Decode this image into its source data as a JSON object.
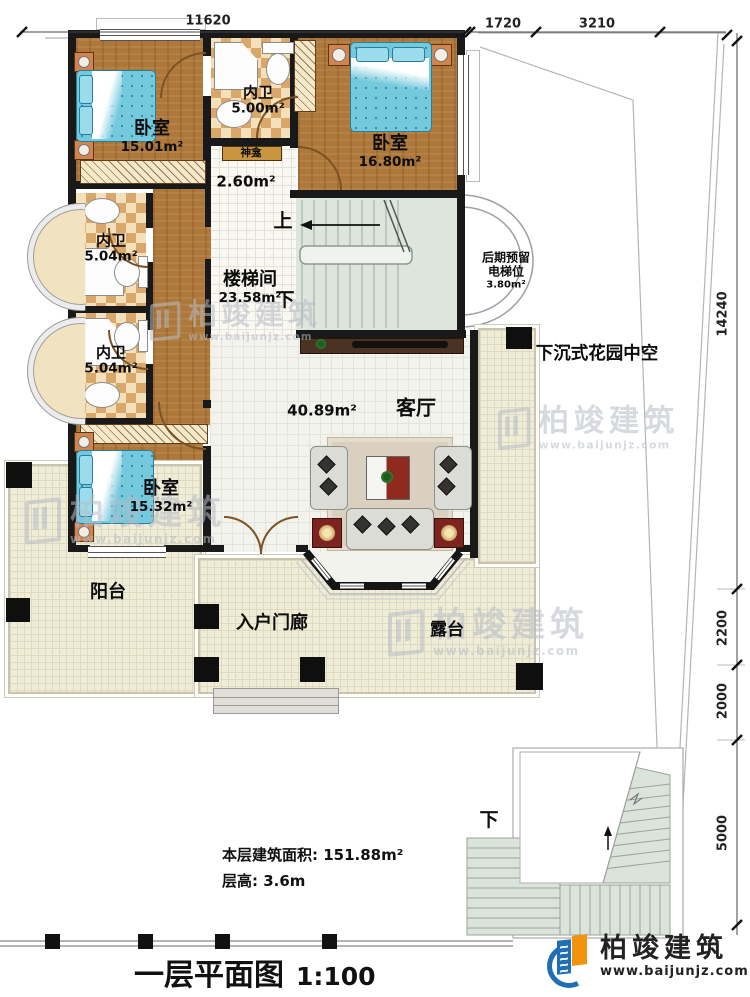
{
  "plan": {
    "title": "一层平面图",
    "scale": "1:100",
    "area_line": "本层建筑面积: 151.88m²",
    "height_line": "层高: 3.6m"
  },
  "dims": {
    "top": "11620",
    "top_right_1": "1720",
    "top_right_2": "3210",
    "right_1": "14240",
    "right_2": "2200",
    "right_3": "2000",
    "right_4": "5000"
  },
  "rooms": {
    "bedroom_tl": {
      "label": "卧室",
      "area": "15.01m²"
    },
    "bath_top": {
      "label": "内卫",
      "area": "5.00m²"
    },
    "shrine": {
      "label": "神龛",
      "area": "2.60m²"
    },
    "bedroom_tr": {
      "label": "卧室",
      "area": "16.80m²"
    },
    "bath_mid": {
      "label": "内卫",
      "area": "5.04m²"
    },
    "bath_low": {
      "label": "内卫",
      "area": "5.04m²"
    },
    "stairwell": {
      "label": "楼梯间",
      "area": "23.58m²"
    },
    "bedroom_bl": {
      "label": "卧室",
      "area": "15.32m²"
    },
    "living": {
      "label": "客厅",
      "area": "40.89m²"
    },
    "balcony": {
      "label": "阳台"
    },
    "porch": {
      "label": "入户门廊"
    },
    "terrace": {
      "label": "露台"
    },
    "garden": {
      "label": "下沉式花园中空"
    },
    "elevator": {
      "line1": "后期预留",
      "line2": "电梯位",
      "area": "3.80m²"
    }
  },
  "marks": {
    "up": "上",
    "down": "下",
    "down_exterior": "下"
  },
  "logo": {
    "brand": "柏竣建筑",
    "site": "www.baijunjz.com"
  },
  "watermark": {
    "brand": "柏竣建筑",
    "site": "www.baijunjz.com"
  }
}
